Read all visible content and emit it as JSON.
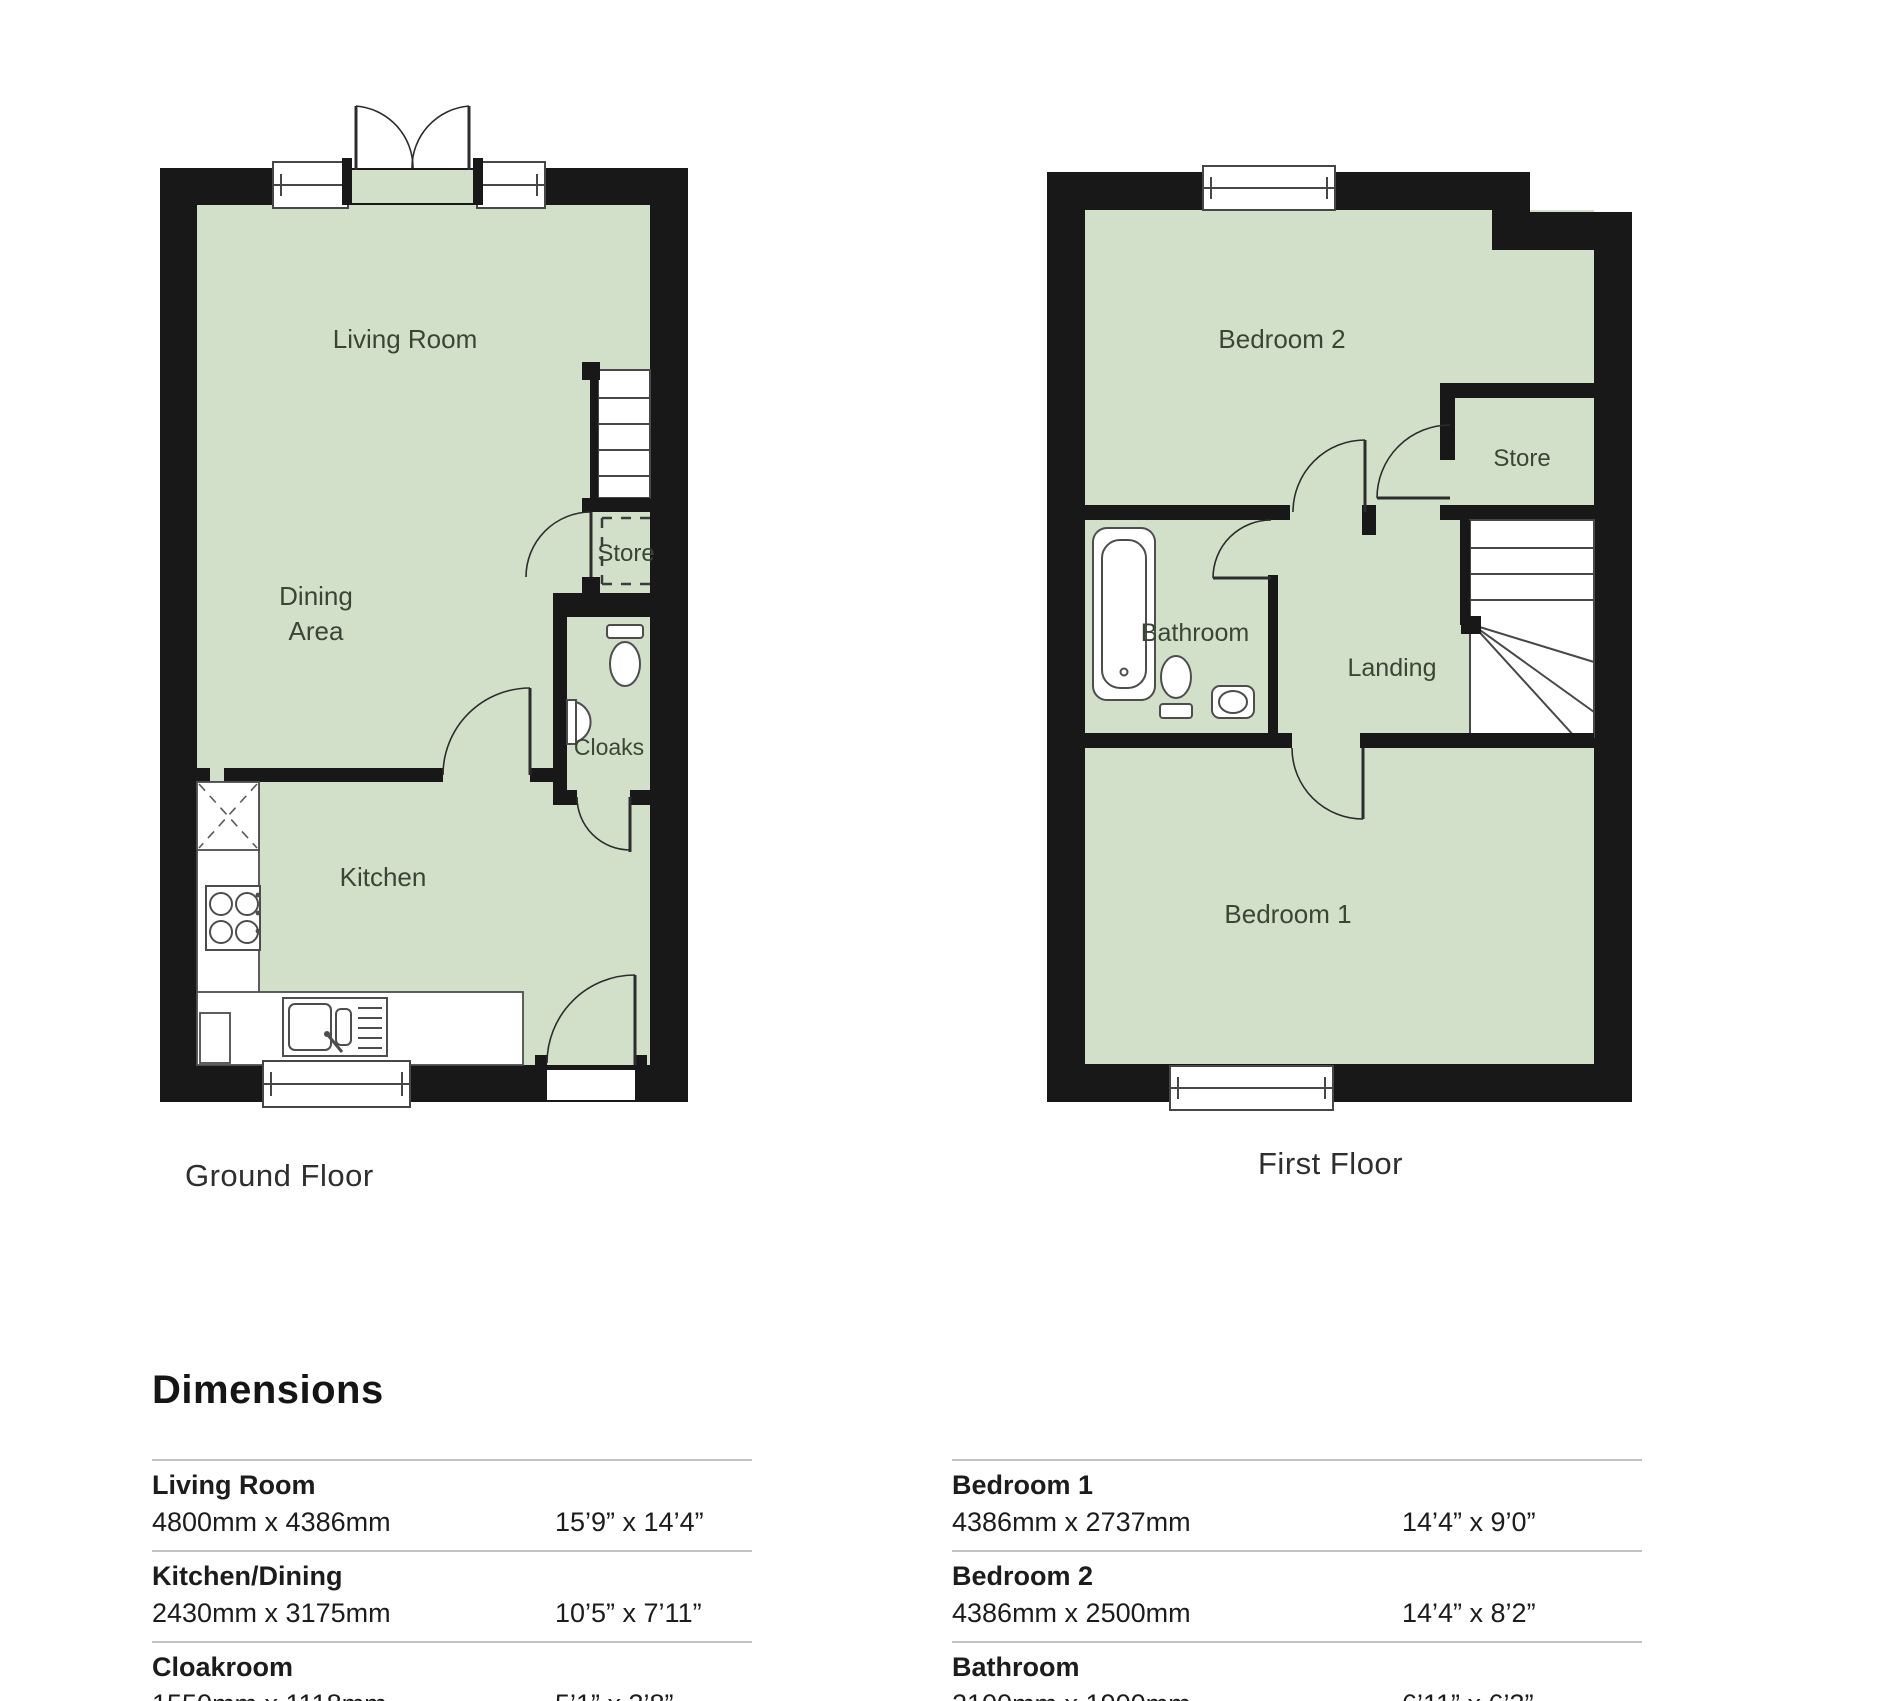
{
  "ground_floor": {
    "caption": "Ground Floor",
    "labels": {
      "living_room": "Living Room",
      "dining_line1": "Dining",
      "dining_line2": "Area",
      "store": "Store",
      "cloaks": "Cloaks",
      "kitchen": "Kitchen"
    }
  },
  "first_floor": {
    "caption": "First Floor",
    "labels": {
      "bedroom2": "Bedroom 2",
      "store": "Store",
      "bathroom": "Bathroom",
      "landing": "Landing",
      "bedroom1": "Bedroom 1"
    }
  },
  "dimensions": {
    "heading": "Dimensions",
    "left": [
      {
        "name": "Living Room",
        "metric": "4800mm x 4386mm",
        "imperial": "15’9” x 14’4”"
      },
      {
        "name": "Kitchen/Dining",
        "metric": "2430mm x 3175mm",
        "imperial": "10’5” x 7’11”"
      },
      {
        "name": "Cloakroom",
        "metric": "1550mm x 1118mm",
        "imperial": "5’1” x 3’8”"
      }
    ],
    "right": [
      {
        "name": "Bedroom 1",
        "metric": "4386mm x 2737mm",
        "imperial": "14’4” x 9’0”"
      },
      {
        "name": "Bedroom 2",
        "metric": "4386mm x 2500mm",
        "imperial": "14’4” x 8’2”"
      },
      {
        "name": "Bathroom",
        "metric": "2100mm x 1900mm",
        "imperial": "6’11” x 6’3”"
      }
    ]
  },
  "colors": {
    "room_fill": "#d3e0c9",
    "wall": "#181818",
    "label_text": "#3a4536",
    "fixture_line": "#4d4d4d",
    "rule": "#c2c2c2"
  }
}
